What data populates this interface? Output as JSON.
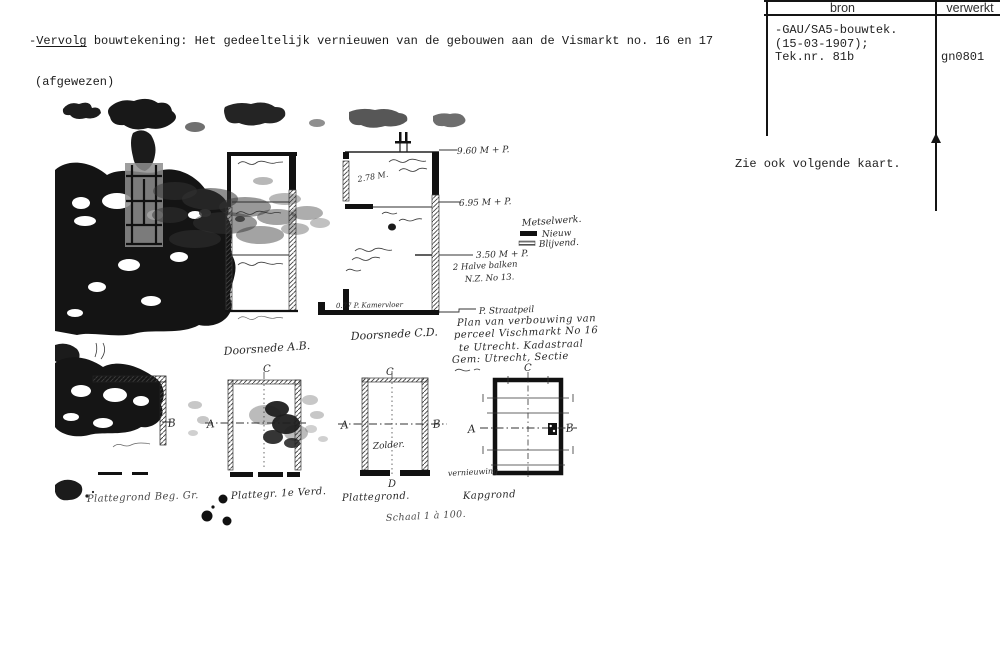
{
  "description": {
    "dash": "-",
    "underlined": "Vervolg",
    "rest": " bouwtekening: Het gedeeltelijk vernieuwen van de gebouwen aan de Vismarkt no. 16 en 17",
    "line2": "(afgewezen)"
  },
  "index_card": {
    "columns": {
      "bron": "bron",
      "verwerkt": "verwerkt"
    },
    "bron_lines": [
      "-GAU/SA5-bouwtek.",
      "(15-03-1907);",
      "Tek.nr. 81b"
    ],
    "verwerkt_value": "gn0801",
    "note": "Zie ook volgende kaart."
  },
  "drawing": {
    "sections": {
      "ab_label": "Doorsnede A.B.",
      "cd_label": "Doorsnede C.D."
    },
    "dimensions": {
      "top": "9.60 M + P.",
      "middle": "6.95 M + P.",
      "lower": "3.50 M + P.",
      "attic": "2.78 M.",
      "floor": "0.77 P. Kamervloer",
      "balken_1": "2 Halve balken",
      "balken_2": "N.Z. No 13.",
      "street_level": "P. Straatpeil"
    },
    "legend": {
      "title": "Metselwerk.",
      "new": "Nieuw",
      "existing": "Blijvend."
    },
    "note_lines": [
      "Plan van verbouwing van het",
      "perceel Vischmarkt No 16",
      "te Utrecht. Kadastraal",
      "Gem: Utrecht, Sectie"
    ],
    "markers": {
      "a": "A",
      "b": "B",
      "c": "C",
      "d": "D"
    },
    "rooms": {
      "zolder": "Zolder."
    },
    "plan_labels": [
      "Plattegrond Beg. Gr.",
      "Plattegr. 1e Verd.",
      "Plattegrond.",
      "Kapgrond"
    ],
    "annotations": {
      "vernieuwing": "vernieuwing",
      "scale": "Schaal 1 à 100."
    }
  }
}
